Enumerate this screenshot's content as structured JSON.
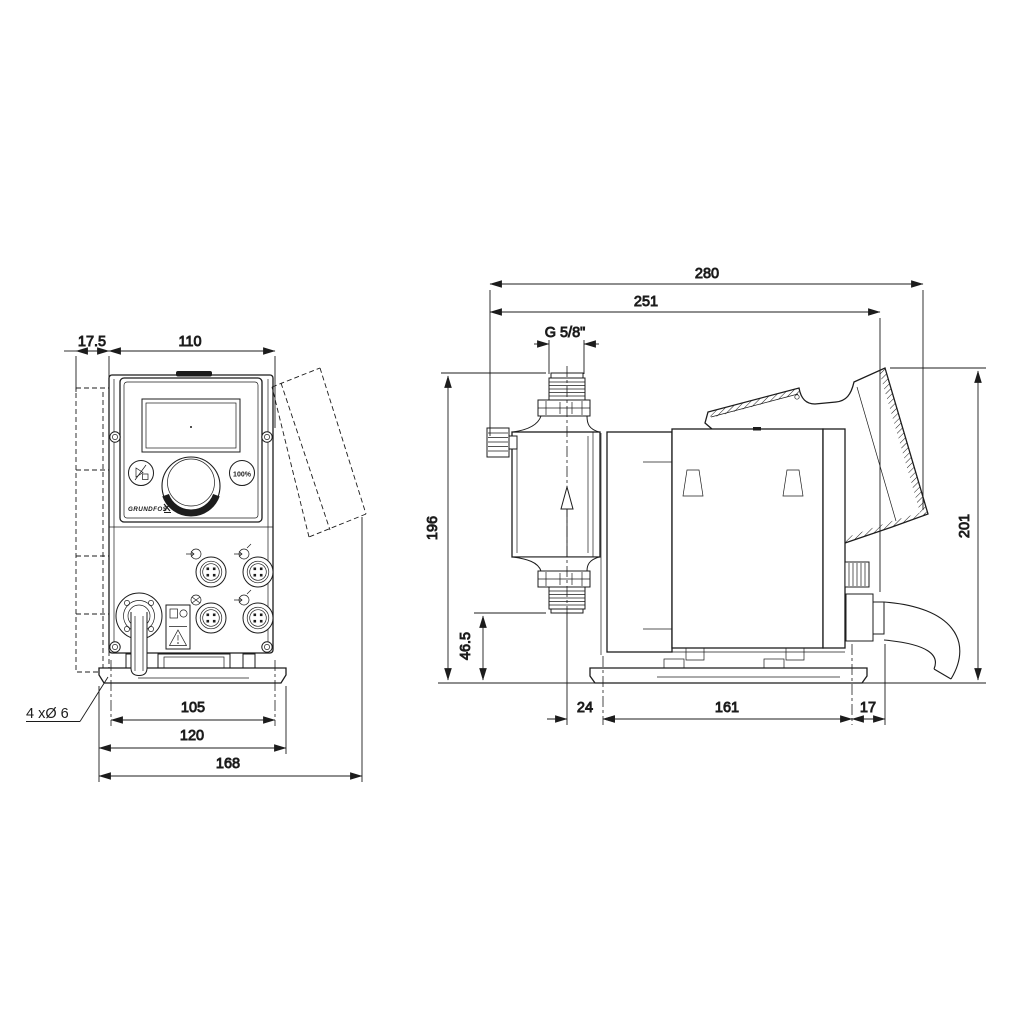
{
  "front": {
    "dim_bracket_offset": "17.5",
    "dim_body_width": "110",
    "dim_hole_spacing": "105",
    "dim_plate_width": "120",
    "dim_total_width": "168",
    "note_mounting_holes": "4 xØ 6",
    "panel": {
      "run_button_label": "100%",
      "brand_logo": "GRUNDFOS"
    }
  },
  "side": {
    "dim_total_depth": "280",
    "dim_depth_to_cable": "251",
    "dim_thread": "G 5/8\"",
    "dim_height_to_port": "196",
    "dim_port_height": "46.5",
    "dim_front_overhang": "24",
    "dim_foot_length": "161",
    "dim_rear_overhang": "17",
    "dim_total_height": "201"
  },
  "colors": {
    "line": "#1c1c1c",
    "paper": "#ffffff"
  }
}
